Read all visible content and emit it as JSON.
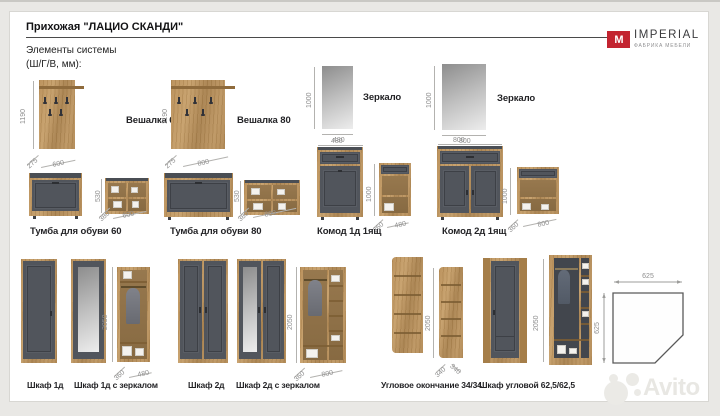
{
  "page": {
    "title": "Прихожая \"ЛАЦИО СКАНДИ\"",
    "subtitle_line1": "Элементы системы",
    "subtitle_line2": "(Ш/Г/В, мм):",
    "watermark": "Avito"
  },
  "logo": {
    "mark": "M",
    "brand": "IMPERIAL",
    "tagline": "ФАБРИКА МЕБЕЛИ"
  },
  "items": {
    "veshalka60": {
      "label": "Вешалка 60",
      "height": "1190",
      "depth": "275",
      "width": "600"
    },
    "veshalka80": {
      "label": "Вешалка 80",
      "height": "1190",
      "depth": "275",
      "width": "800"
    },
    "zerkalo480": {
      "label": "Зеркало",
      "height": "1000",
      "width": "480"
    },
    "zerkalo800": {
      "label": "Зеркало",
      "height": "1000",
      "width": "800"
    },
    "tumba60": {
      "label": "Тумба для обуви 60",
      "height": "530",
      "depth": "380",
      "width": "600"
    },
    "tumba80": {
      "label": "Тумба для обуви 80",
      "height": "530",
      "depth": "380",
      "width": "800"
    },
    "komod1": {
      "label": "Комод 1д 1ящ",
      "front_width": "480",
      "height": "1000",
      "depth": "360",
      "width": "480"
    },
    "komod2": {
      "label": "Комод 2д 1ящ",
      "front_width": "800",
      "height": "1000",
      "depth": "360",
      "width": "800"
    },
    "shkaf1": {
      "label": "Шкаф 1д"
    },
    "shkaf1z": {
      "label": "Шкаф 1д с зеркалом",
      "height": "2050",
      "depth": "360",
      "width": "480"
    },
    "shkaf2": {
      "label": "Шкаф 2д"
    },
    "shkaf2z": {
      "label": "Шкаф 2д с зеркалом",
      "height": "2050",
      "depth": "360",
      "width": "800"
    },
    "uglovoe": {
      "label": "Угловое окончание 34/34",
      "height": "2050",
      "depth_left": "340",
      "depth_right": "340"
    },
    "shkaf_uglovoy": {
      "label": "Шкаф угловой 62,5/62,5",
      "height": "2050",
      "plan_width": "625",
      "plan_depth": "625"
    }
  }
}
